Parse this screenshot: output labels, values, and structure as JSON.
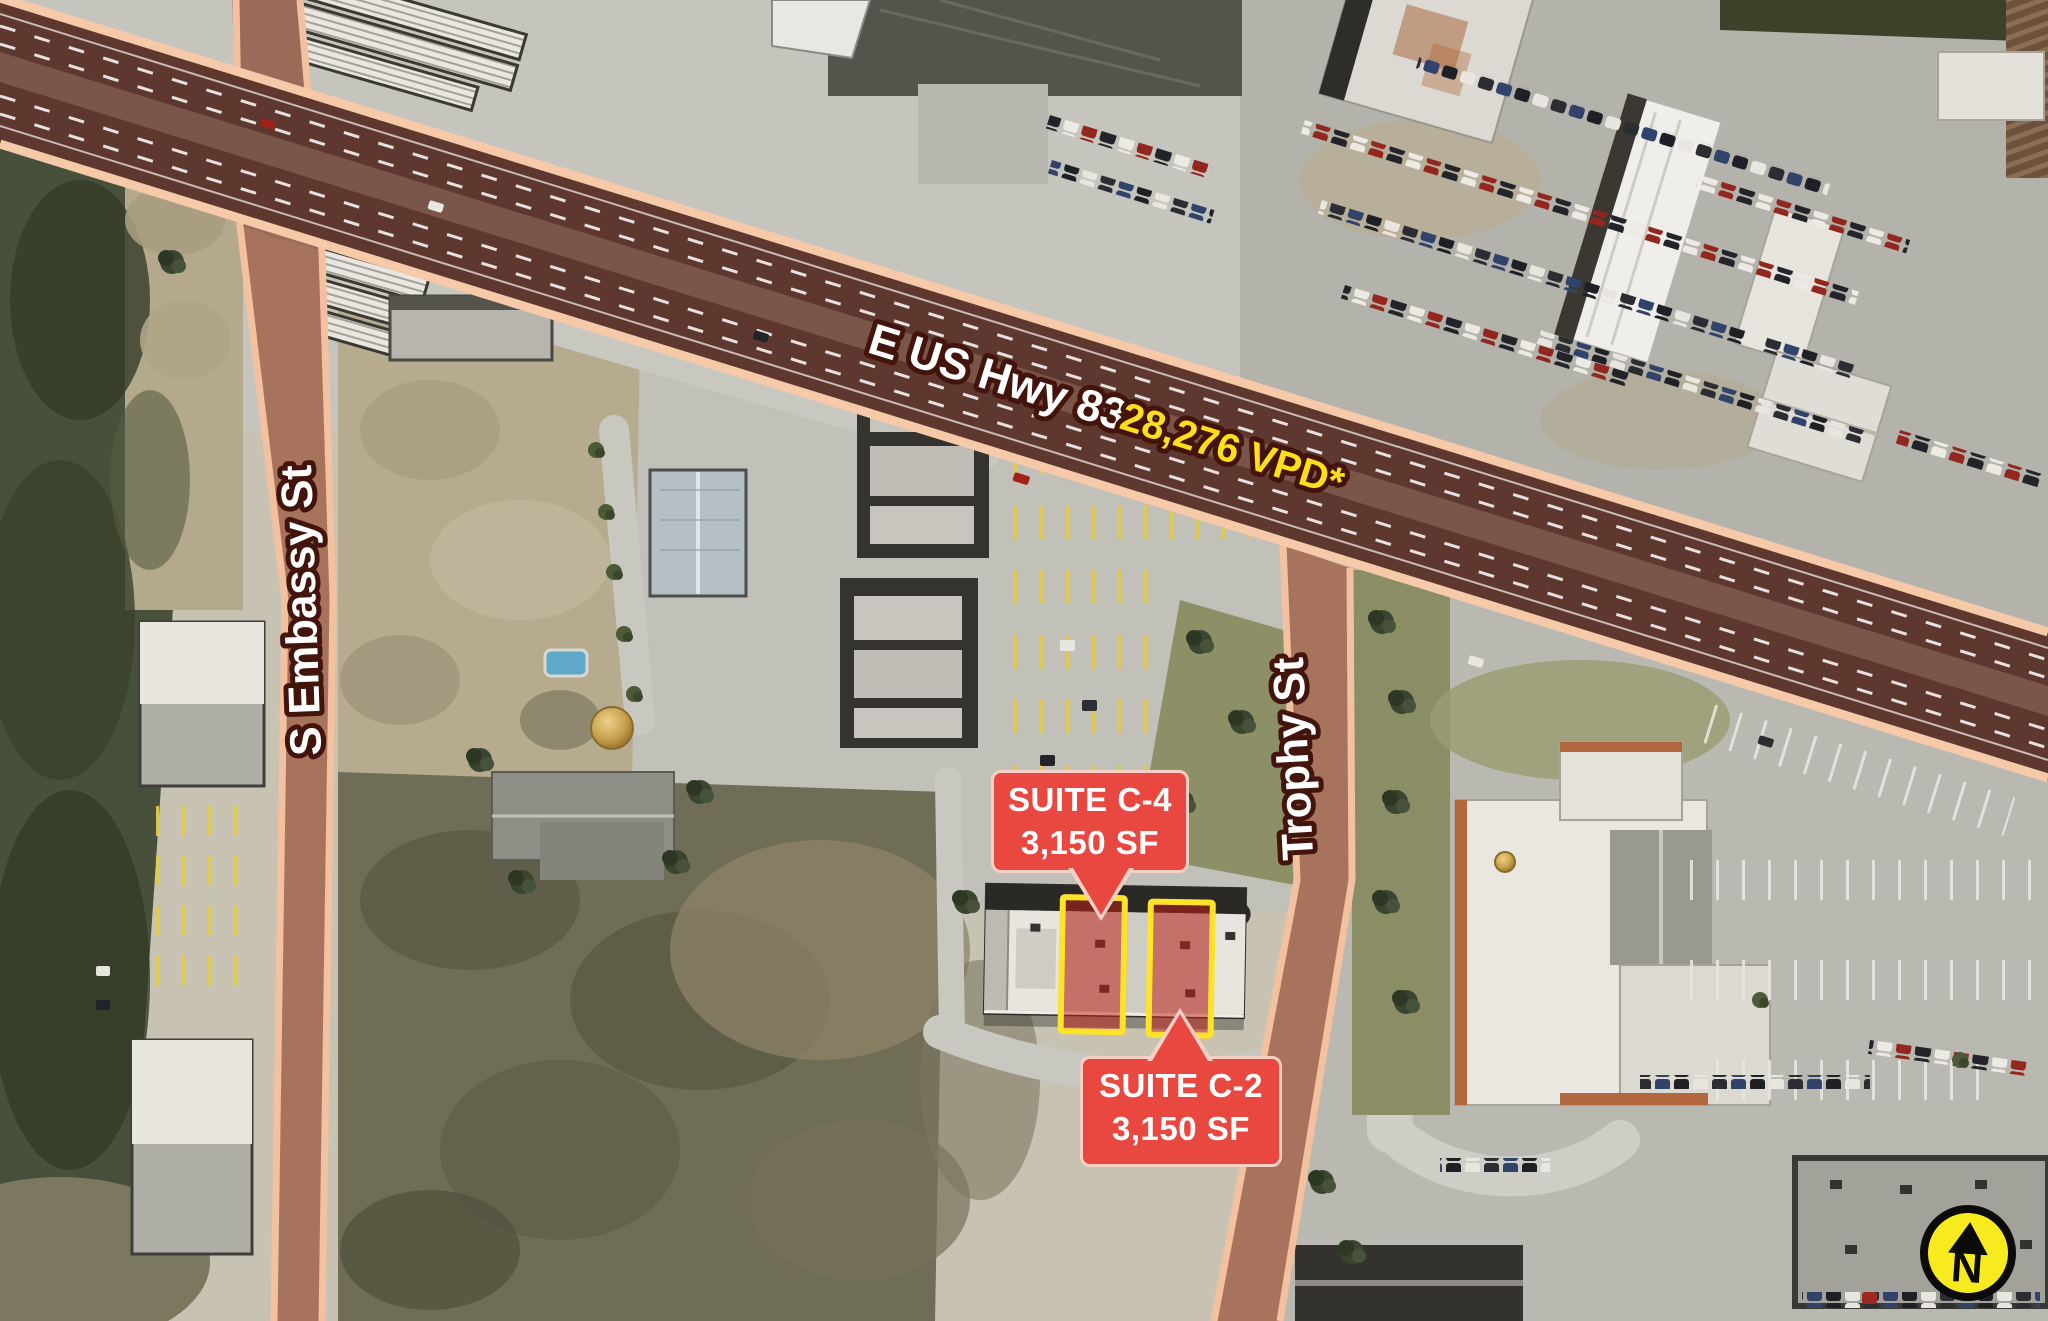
{
  "labels": {
    "highway": "E US Hwy 83",
    "traffic": "28,276 VPD*",
    "street_embassy": "S Embassy St",
    "street_trophy": "Trophy St",
    "north": "N"
  },
  "callouts": [
    {
      "title": "SUITE C-4",
      "size": "3,150 SF"
    },
    {
      "title": "SUITE C-2",
      "size": "3,150 SF"
    }
  ],
  "colors": {
    "callout_red": "#e94840",
    "callout_border": "#f6cfc5",
    "suite_outline_yellow": "#ffe32b",
    "road_overlay_edge": "#f3c19f",
    "road_overlay_fill": "#5e372e",
    "traffic_text_yellow": "#ffdf1b",
    "north_badge_yellow": "#f7ea1e"
  }
}
